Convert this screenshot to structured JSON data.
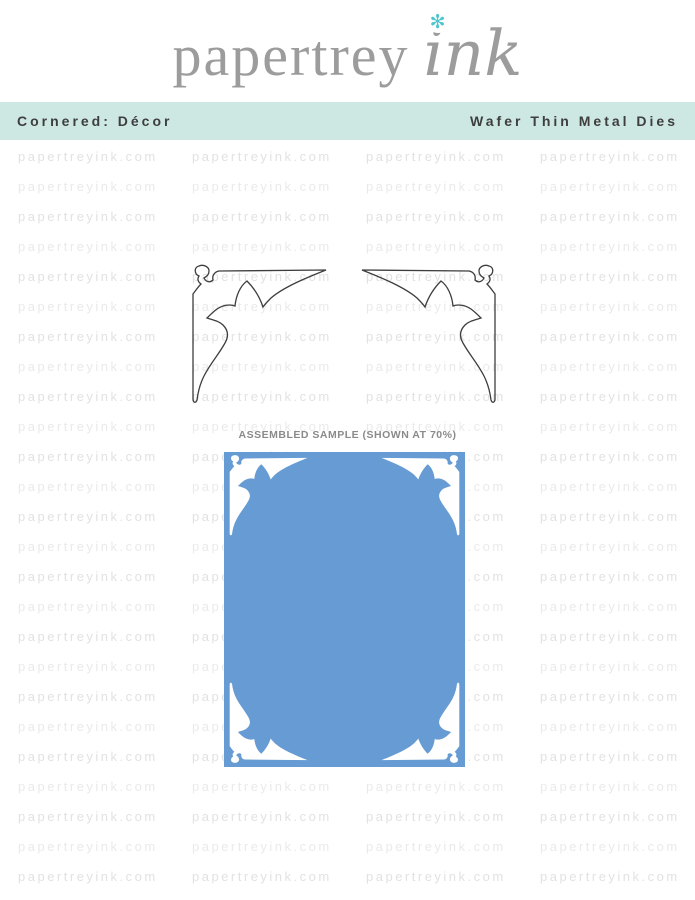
{
  "header": {
    "brand_serif": "papertrey",
    "brand_script": "ink",
    "flower_icon": "✻"
  },
  "banner": {
    "left_label": "Cornered: Décor",
    "right_label": "Wafer Thin Metal Dies"
  },
  "watermark": {
    "text": "papertreyink.com",
    "rows": 26,
    "cols": 4
  },
  "sample": {
    "label": "ASSEMBLED SAMPLE (SHOWN AT 70%)"
  },
  "colors": {
    "banner_bg": "#cde8e3",
    "banner_text": "#3e3e3e",
    "logo_gray": "#9c9c9c",
    "flower_teal": "#4cc5ce",
    "watermark_a": "#e2e2e2",
    "watermark_b": "#eaeaea",
    "die_stroke": "#3e3e3e",
    "card_blue": "#679bd3",
    "card_corner_white": "#ffffff",
    "sample_label_gray": "#8a8a8a"
  }
}
